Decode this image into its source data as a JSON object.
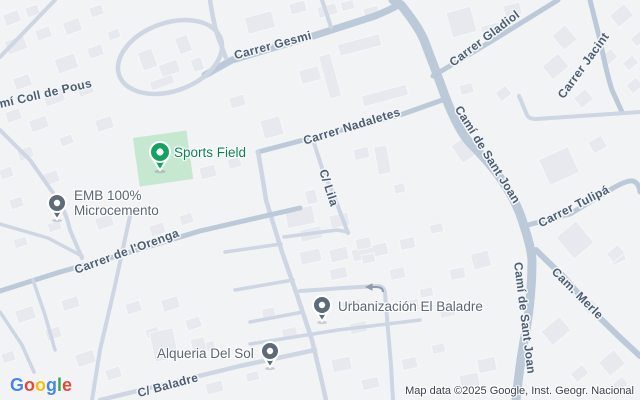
{
  "map": {
    "roads": {
      "gesmi": "Carrer Gesmi",
      "coll_de_pous": "Camí Coll de Pous",
      "nadaletes": "Carrer Nadaletes",
      "lila": "C/ Lila",
      "sant_joan_top": "Camí de Sant Joan",
      "sant_joan_bottom": "Camí de Sant Joan",
      "gladiol": "Carrer Gladiol",
      "jacint": "Carrer Jacint",
      "tulipa": "Carrer Tulipá",
      "merle": "Cam. Merle",
      "orenga": "Carrer de l'Orenga",
      "baladre_street": "C/ Baladre"
    },
    "pois": {
      "sports_field": {
        "name": "Sports Field"
      },
      "emb": {
        "line1": "EMB 100%",
        "line2": "Microcemento"
      },
      "urbanizacion": {
        "name": "Urbanización El Baladre"
      },
      "alqueria": {
        "name": "Alqueria Del Sol"
      }
    }
  },
  "footer": {
    "logo_letters": [
      {
        "ch": "G",
        "color": "#4285F4"
      },
      {
        "ch": "o",
        "color": "#EA4335"
      },
      {
        "ch": "o",
        "color": "#FBBC05"
      },
      {
        "ch": "g",
        "color": "#4285F4"
      },
      {
        "ch": "l",
        "color": "#34A853"
      },
      {
        "ch": "e",
        "color": "#EA4335"
      }
    ],
    "attribution": "Map data ©2025 Google, Inst. Geogr. Nacional"
  },
  "colors": {
    "bg": "#f2f3f5",
    "building": "#e7e9ef",
    "road-major": "#bcc9d8",
    "road-minor": "#cdd6e2",
    "field-green": "#c7e8d0",
    "poi-green": "#0d7f52",
    "marker-green": "#14a263",
    "poi-gray": "#5b6774",
    "marker-gray": "#5d6b79",
    "road-label": "#4c5e72",
    "attribution": "#3a424c"
  }
}
